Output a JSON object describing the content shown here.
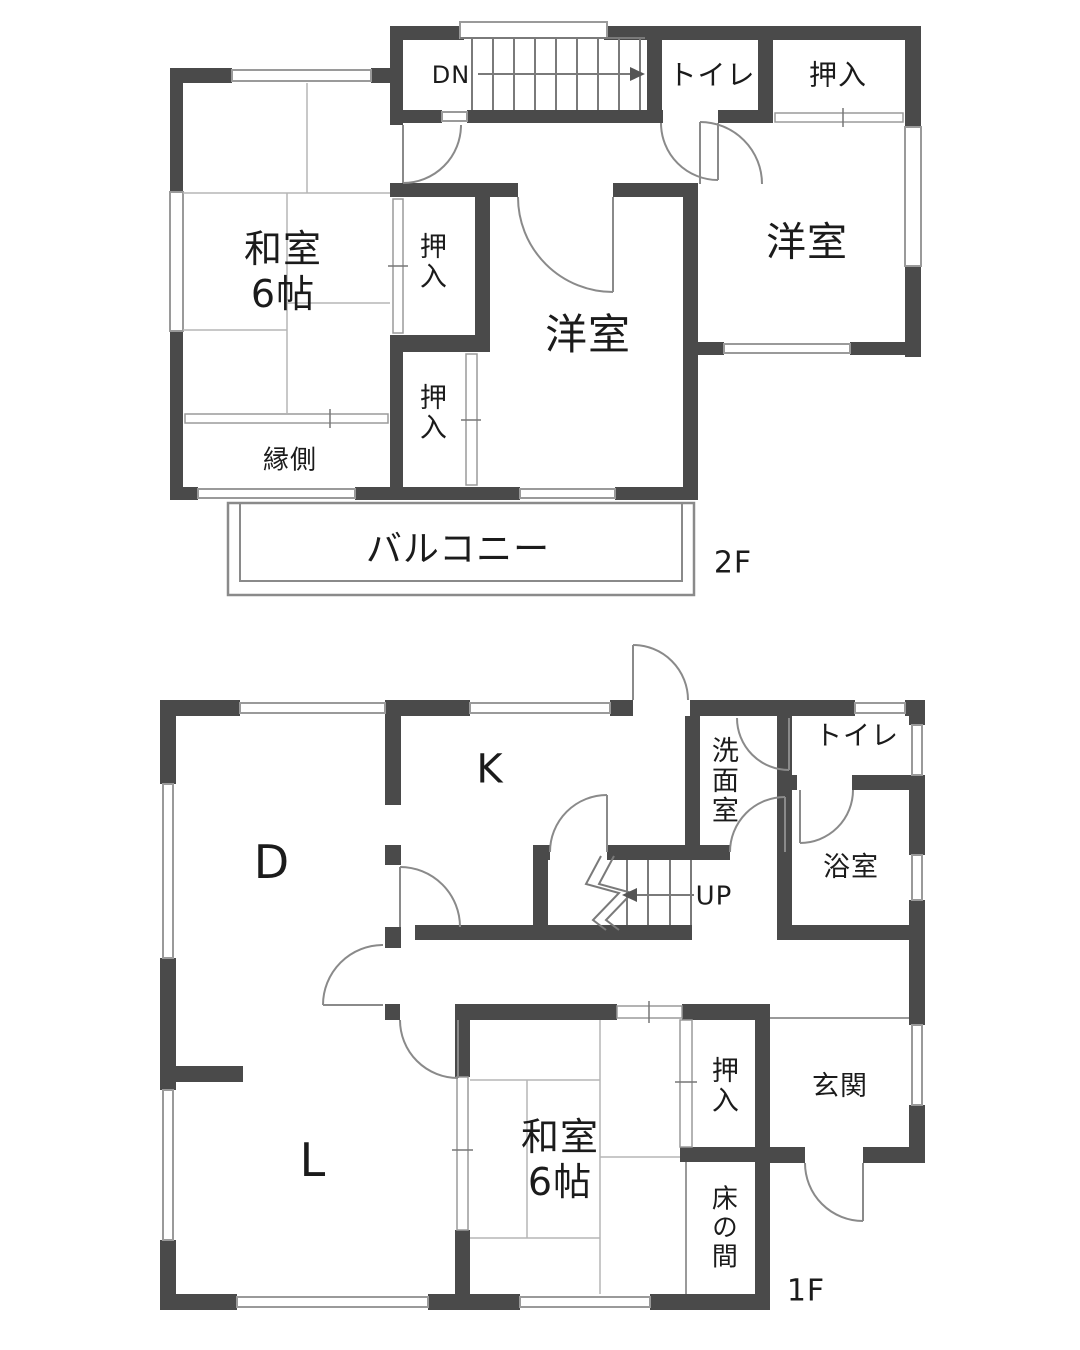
{
  "colors": {
    "wall": "#4a4a4a",
    "door_line": "#888888",
    "thin_line": "#9a9a9a",
    "tatami_line": "#b5b5b5",
    "text": "#1b1b1b",
    "background": "#ffffff"
  },
  "floor2": {
    "floor_tag": "2F",
    "stairs_label": "DN",
    "rooms": {
      "washitsu": "和室\n6帖",
      "oshiire_top": "押入",
      "oshiire_upper": "押入",
      "oshiire_lower": "押入",
      "toilet": "トイレ",
      "yoshitsu_center": "洋室",
      "yoshitsu_right": "洋室",
      "engawa": "縁側",
      "balcony": "バルコニー"
    }
  },
  "floor1": {
    "floor_tag": "1F",
    "stairs_label": "UP",
    "rooms": {
      "dining": "D",
      "kitchen": "K",
      "living": "L",
      "washitsu": "和室\n6帖",
      "senmen": "洗面室",
      "toilet": "トイレ",
      "bath": "浴室",
      "oshiire": "押入",
      "genkan": "玄関",
      "tokonoma": "床の間"
    }
  }
}
